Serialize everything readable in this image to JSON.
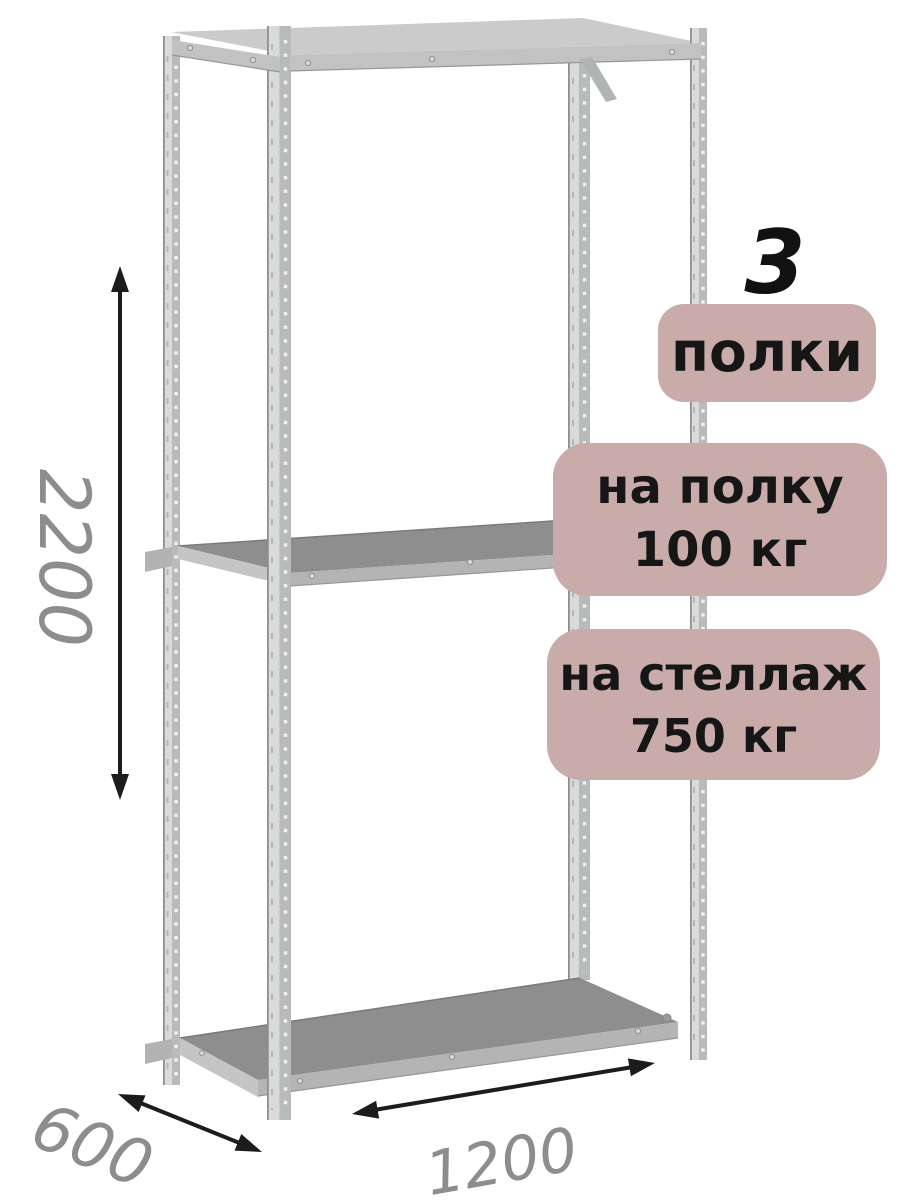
{
  "product_diagram": {
    "shelf_count": {
      "number": "3",
      "label": "полки"
    },
    "load_per_shelf": {
      "line1": "на полку",
      "line2": "100 кг"
    },
    "load_per_rack": {
      "line1": "на стеллаж",
      "line2": "750 кг"
    },
    "dimensions": {
      "height_mm": "2200",
      "depth_mm": "600",
      "width_mm": "1200"
    }
  },
  "colors": {
    "background": "#ffffff",
    "badge_bg": "#c9abaa",
    "badge_text": "#161616",
    "number_color": "#111111",
    "dim_text": "#8d8d8d",
    "arrow": "#1c1c1c",
    "post_light": "#dadada",
    "post_dark": "#b7bbbb",
    "post_edge": "#8f8f8f",
    "post_hole": "#f1f1f1",
    "shelf_surface": "#8e8e8e",
    "shelf_edge": "#b4b4b4",
    "beam": "#c2c2c2"
  }
}
